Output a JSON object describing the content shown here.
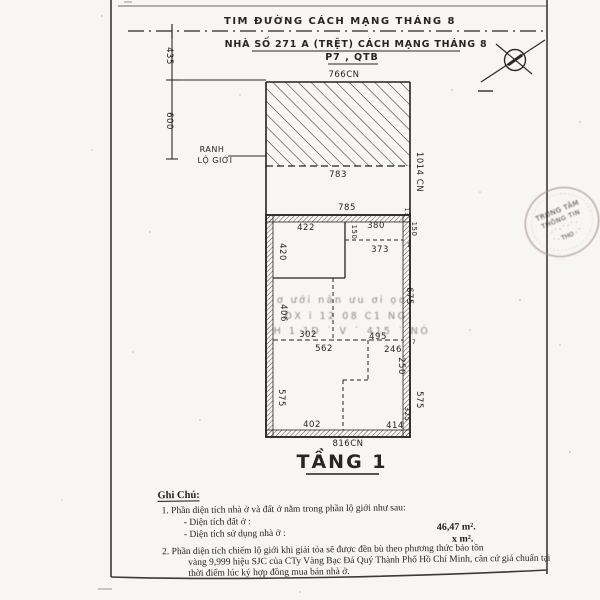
{
  "header": {
    "centerline": "TIM ĐƯỜNG CÁCH MẠNG THÁNG 8",
    "address1": "NHÀ SỐ 271 A (TRỆT) CÁCH MẠNG THÁNG 8",
    "address2": "P7 , QTB"
  },
  "plan": {
    "title": "TẦNG 1",
    "labels": [
      {
        "t": "766CN",
        "x": 344,
        "y": 77
      },
      {
        "t": "783",
        "x": 338,
        "y": 177
      },
      {
        "t": "1014 CN",
        "x": 417,
        "y": 172,
        "r": 90
      },
      {
        "t": "435",
        "x": 167,
        "y": 56,
        "r": 90
      },
      {
        "t": "600",
        "x": 167,
        "y": 121,
        "r": 90
      },
      {
        "t": "RANH",
        "x": 212,
        "y": 152,
        "s": 8
      },
      {
        "t": "LỘ GIỚI",
        "x": 215,
        "y": 163,
        "s": 8
      },
      {
        "t": "785",
        "x": 347,
        "y": 210
      },
      {
        "t": "422",
        "x": 306,
        "y": 230
      },
      {
        "t": "380",
        "x": 376,
        "y": 228
      },
      {
        "t": "150",
        "x": 352,
        "y": 232,
        "r": 90,
        "s": 7
      },
      {
        "t": "373",
        "x": 380,
        "y": 252
      },
      {
        "t": "420",
        "x": 280,
        "y": 252,
        "r": 90
      },
      {
        "t": "13",
        "x": 405,
        "y": 212,
        "r": 90,
        "s": 6
      },
      {
        "t": "150",
        "x": 412,
        "y": 229,
        "r": 90,
        "s": 7
      },
      {
        "t": "1",
        "x": 409,
        "y": 247,
        "s": 6
      },
      {
        "t": "675",
        "x": 407,
        "y": 296,
        "r": 90
      },
      {
        "t": "406",
        "x": 281,
        "y": 313,
        "r": 90
      },
      {
        "t": "302",
        "x": 308,
        "y": 337
      },
      {
        "t": "495",
        "x": 378,
        "y": 339
      },
      {
        "t": "562",
        "x": 324,
        "y": 351
      },
      {
        "t": "246",
        "x": 393,
        "y": 352
      },
      {
        "t": "7",
        "x": 414,
        "y": 344,
        "s": 6
      },
      {
        "t": "250",
        "x": 399,
        "y": 366,
        "r": 90
      },
      {
        "t": "575",
        "x": 279,
        "y": 398,
        "r": 90
      },
      {
        "t": "575",
        "x": 417,
        "y": 400,
        "r": 90
      },
      {
        "t": "325",
        "x": 405,
        "y": 414,
        "r": 90,
        "s": 7
      },
      {
        "t": "402",
        "x": 312,
        "y": 427
      },
      {
        "t": "414",
        "x": 395,
        "y": 428
      },
      {
        "t": "816CN",
        "x": 348,
        "y": 446
      }
    ]
  },
  "notes": {
    "title": "Ghi Chú:",
    "n1": "1.   Phần diện tích nhà ở và đất ở nằm trong phần lộ giới như sau:",
    "n1a": "- Diện tích đất ở :",
    "n1b": "- Diện tích sử dụng nhà ở :",
    "v1": "46,47 m².",
    "v2": "x m².",
    "n2a": "2.   Phần diện tích chiếm lộ giới khi giải tỏa sẽ được đền bù theo phương thức bảo tồn",
    "n2b": "vàng 9,999 hiệu SJC của CTy Vàng Bạc Đá Quý Thành Phố Hồ Chí Minh, căn cứ giá chuẩn tại",
    "n2c": "thời điểm lúc ký hợp đồng mua bán nhà ở."
  },
  "stamp": {
    "line1": "TRUNG TÂM",
    "line2": "THÔNG TIN",
    "line3": "· ˙ · ˙ · ˙ ·",
    "line4": "˙ · THO · ˙"
  },
  "bleedthrough": {
    "lines": [
      {
        "t": "ơ ưới nản ưu   ơi   ọo",
        "x": 342,
        "y": 303
      },
      {
        "t": "ĐX i 12   08  C1   NG",
        "x": 346,
        "y": 319
      },
      {
        "t": "H 1 1D ˙ V ˙ 415 ˙ NÓ",
        "x": 352,
        "y": 334
      }
    ]
  },
  "colors": {
    "ink": "#242424",
    "stamp": "#a98f8c",
    "bleed": "#9b8a84",
    "paper": "#f7f6f2"
  }
}
